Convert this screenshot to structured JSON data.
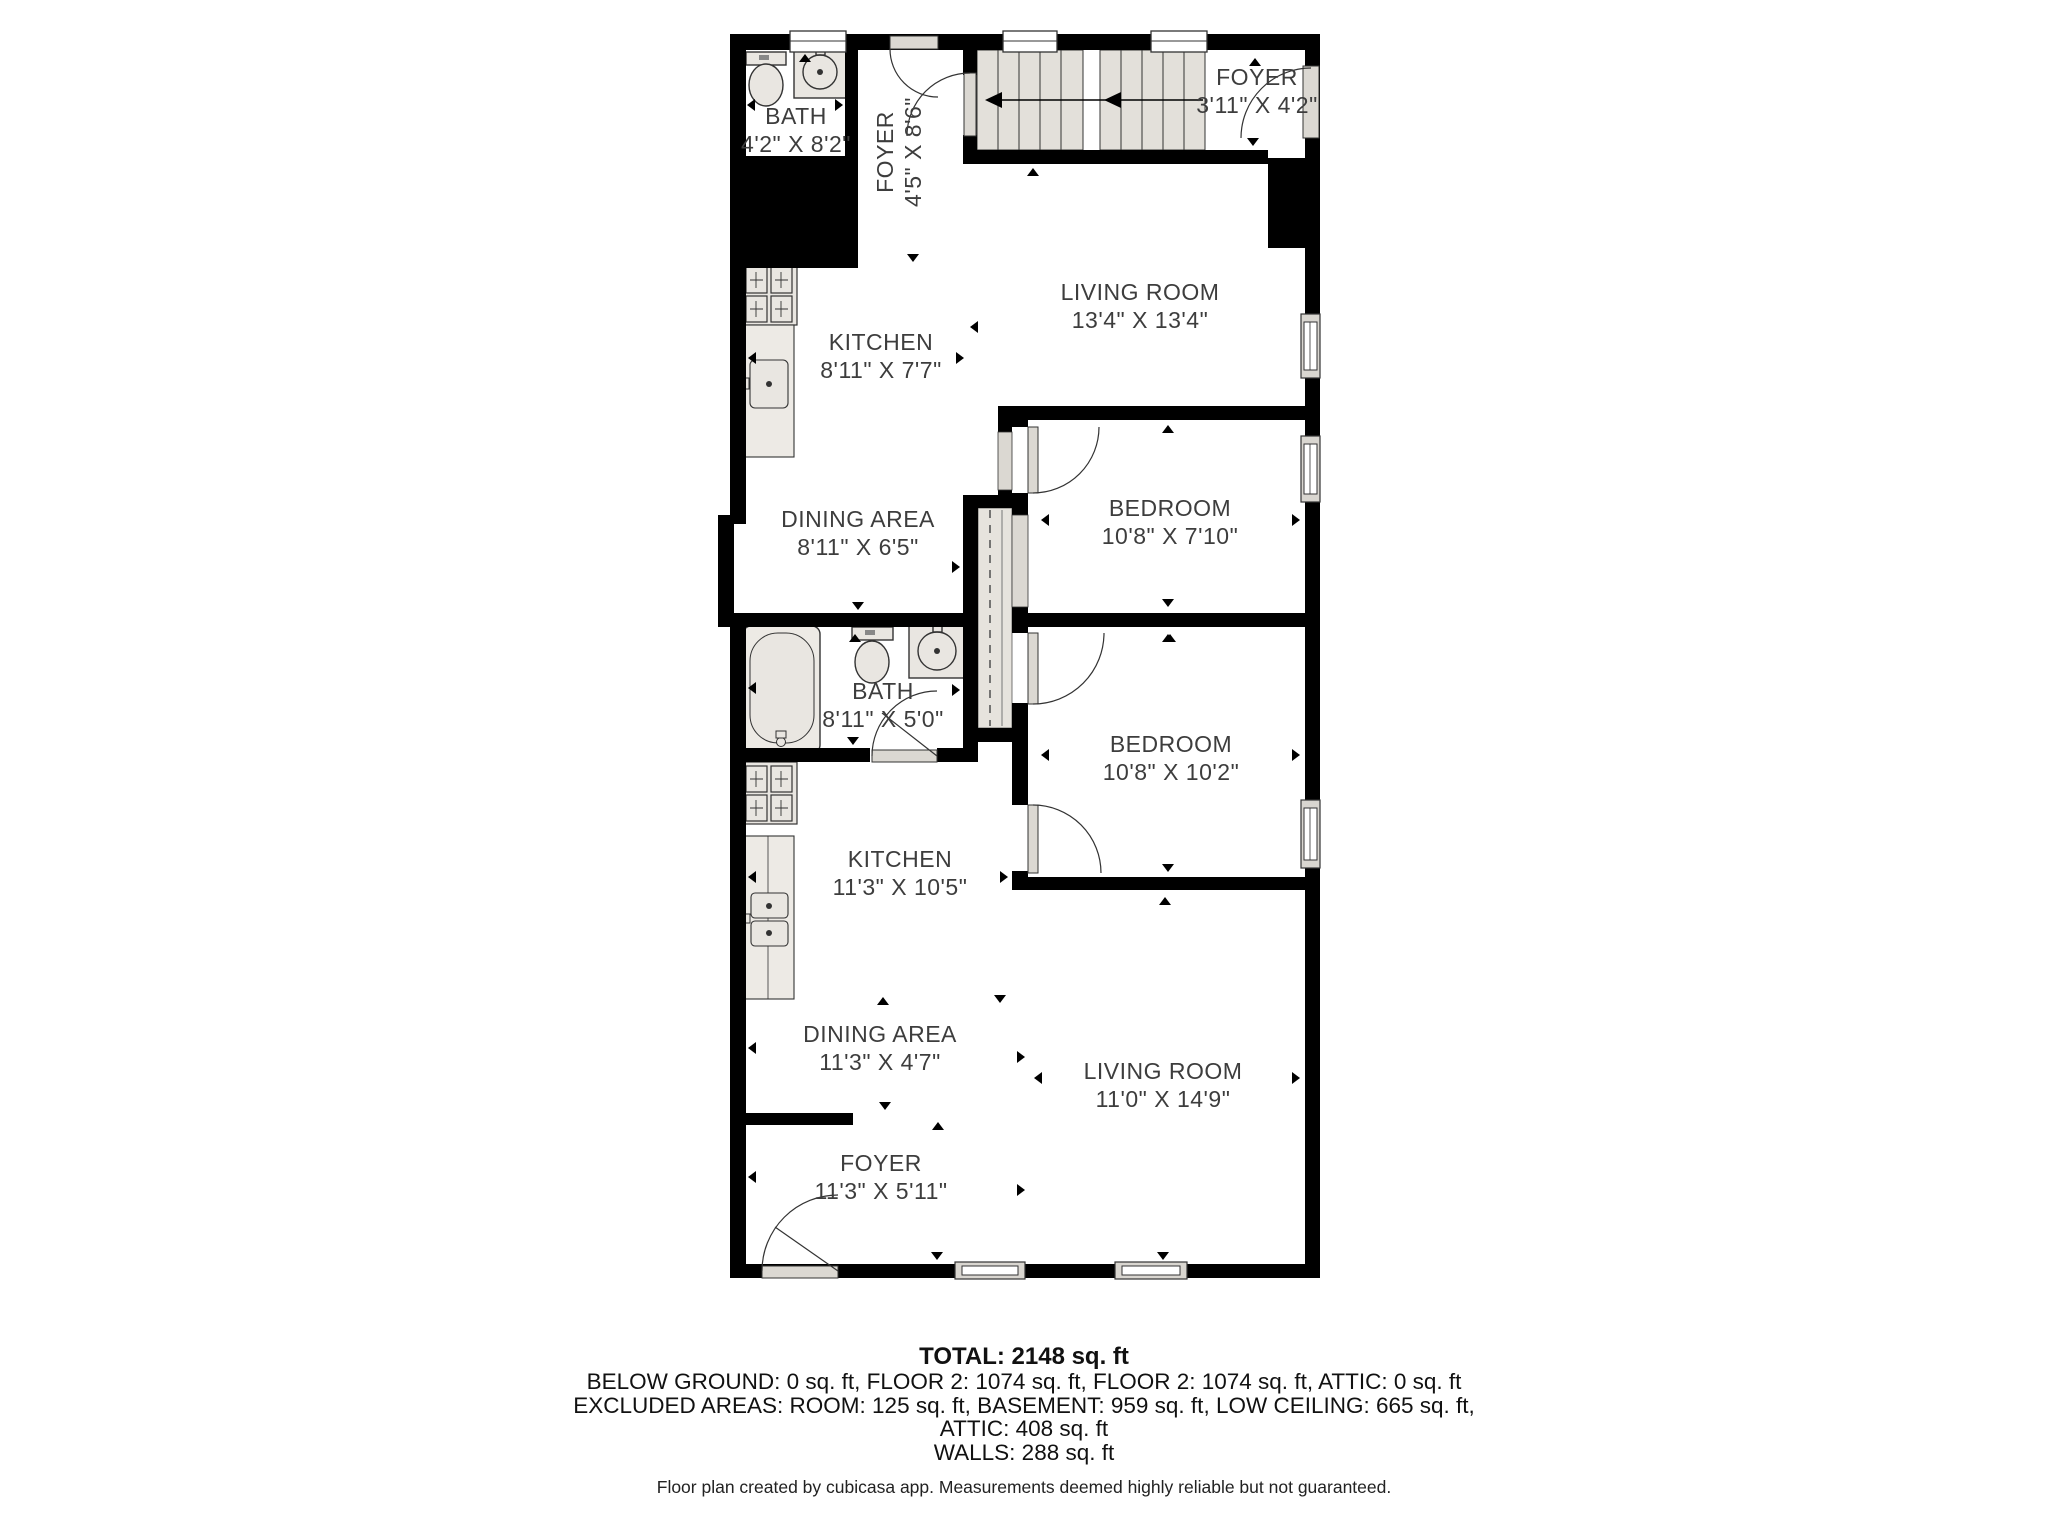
{
  "rooms": [
    {
      "id": "bath-upper",
      "name": "BATH",
      "dims": "4'2\" X 8'2\""
    },
    {
      "id": "foyer-upper",
      "name": "FOYER",
      "dims": "4'5\" X 8'6\""
    },
    {
      "id": "foyer-top-right",
      "name": "FOYER",
      "dims": "3'11\" X 4'2\""
    },
    {
      "id": "living-upper",
      "name": "LIVING ROOM",
      "dims": "13'4\" X 13'4\""
    },
    {
      "id": "kitchen-upper",
      "name": "KITCHEN",
      "dims": "8'11\" X 7'7\""
    },
    {
      "id": "dining-upper",
      "name": "DINING AREA",
      "dims": "8'11\" X 6'5\""
    },
    {
      "id": "bedroom-1",
      "name": "BEDROOM",
      "dims": "10'8\" X 7'10\""
    },
    {
      "id": "bath-mid",
      "name": "BATH",
      "dims": "8'11\" X 5'0\""
    },
    {
      "id": "bedroom-2",
      "name": "BEDROOM",
      "dims": "10'8\" X 10'2\""
    },
    {
      "id": "kitchen-lower",
      "name": "KITCHEN",
      "dims": "11'3\" X 10'5\""
    },
    {
      "id": "dining-lower",
      "name": "DINING AREA",
      "dims": "11'3\" X 4'7\""
    },
    {
      "id": "living-lower",
      "name": "LIVING ROOM",
      "dims": "11'0\" X 14'9\""
    },
    {
      "id": "foyer-lower",
      "name": "FOYER",
      "dims": "11'3\" X 5'11\""
    }
  ],
  "summary": {
    "total": "TOTAL: 2148 sq. ft",
    "line1": "BELOW GROUND: 0 sq. ft, FLOOR 2: 1074 sq. ft, FLOOR 2: 1074 sq. ft, ATTIC: 0 sq. ft",
    "line2": "EXCLUDED AREAS: ROOM: 125 sq. ft, BASEMENT: 959 sq. ft, LOW CEILING: 665 sq. ft,",
    "line3": "ATTIC: 408 sq. ft",
    "line4": "WALLS: 288 sq. ft",
    "footer": "Floor plan created by cubicasa app. Measurements deemed highly reliable but not guaranteed."
  },
  "colors": {
    "wall": "#000000",
    "fixture_fill": "#e9e6e1",
    "fixture_fill_light": "#edeae5",
    "door_panel": "#dbd8d2",
    "stair_fill": "#e3e0da",
    "label_text": "#3d3d3d"
  }
}
